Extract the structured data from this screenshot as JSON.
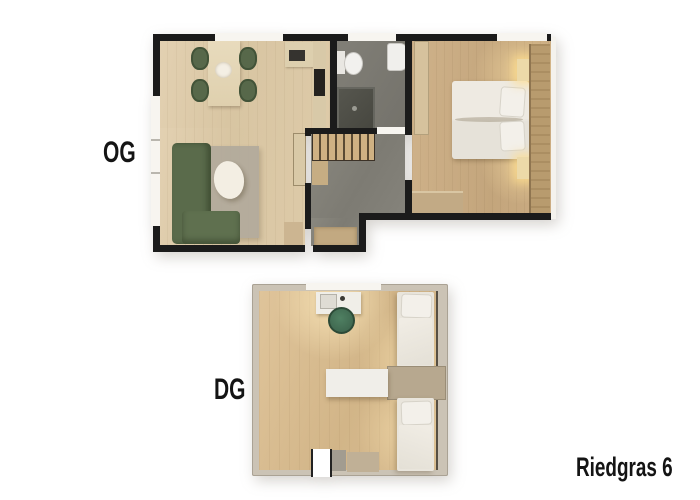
{
  "labels": {
    "upper_floor": "OG",
    "attic_floor": "DG",
    "address": "Riedgras 6"
  },
  "palette": {
    "wall_black": "#1b1b1b",
    "window_white": "#f7f5f0",
    "wood_living": "#dcc9a7",
    "wood_bedroom": "#c9ab82",
    "wood_attic": "#d9bd92",
    "tile_gray": "#83817a",
    "shower_gray": "#50504b",
    "sofa_green": "#5a6b4b",
    "chair_green": "#57684a",
    "desk_chair_green": "#467457",
    "counter_beige": "#ddcfae",
    "attic_wall_tan": "#cbc3b5",
    "cabinet_tan": "#b7a88f",
    "glow_warm": "#f3dfae",
    "fixture_white": "#f2f1ee"
  }
}
